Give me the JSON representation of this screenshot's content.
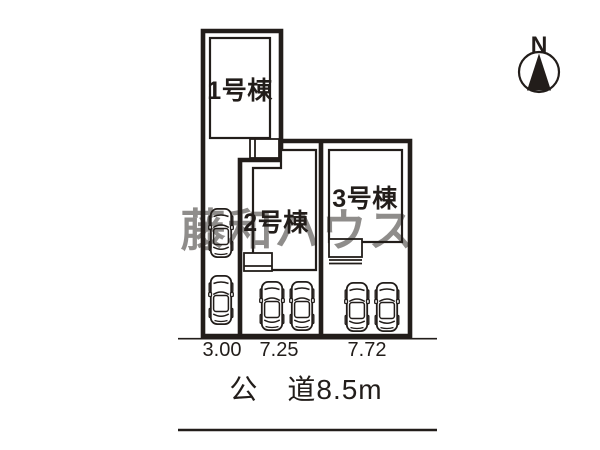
{
  "plan": {
    "lots": [
      {
        "label": "1号棟",
        "frontage": "3.00"
      },
      {
        "label": "2号棟",
        "frontage": "7.25"
      },
      {
        "label": "3号棟",
        "frontage": "7.72"
      }
    ],
    "road_label": "公　道8.5m",
    "compass_label": "N",
    "watermark_text": "藤和ハウス"
  },
  "colors": {
    "background": "#ffffff",
    "line": "#221d1a",
    "watermark": "#9b9b9b"
  }
}
